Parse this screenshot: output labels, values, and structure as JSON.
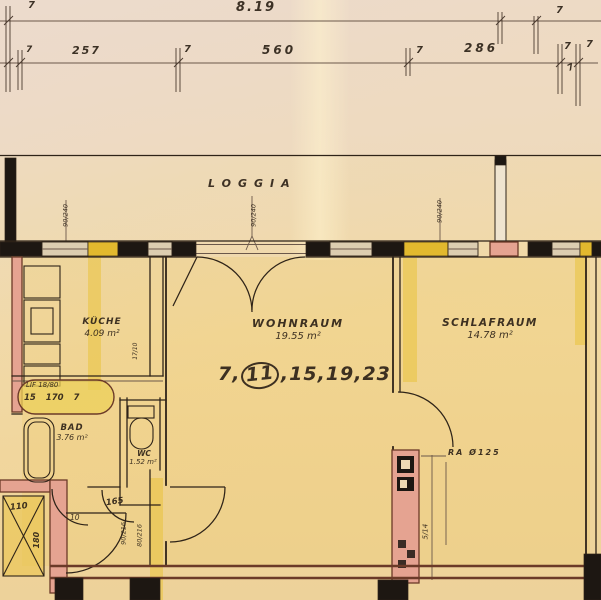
{
  "colors": {
    "paper": "#eed9b4",
    "ink": "#2e2318",
    "line_faint": "#6b584a",
    "dim": "#4a3a2e",
    "wall_black": "#1d1712",
    "wall_pink": "#e5a391",
    "wall_yellow": "#e2b92e",
    "window_beige": "#dccdb0",
    "wall_outline": "#6b3a28",
    "wash": "#eac23c"
  },
  "dimensions": {
    "overall": "8.19",
    "seg_left": "257",
    "seg_middle": "560",
    "seg_right": "286",
    "tick": "7"
  },
  "loggia": {
    "label": "LOGGIA"
  },
  "rooms": {
    "kueche": {
      "name": "KÜCHE",
      "area": "4.09 m²"
    },
    "wohnraum": {
      "name": "WOHNRAUM",
      "area": "19.55 m²"
    },
    "schlafraum": {
      "name": "SCHLAFRAUM",
      "area": "14.78 m²"
    },
    "bad": {
      "name": "BAD",
      "area": "3.76 m²"
    },
    "wc": {
      "name": "WC",
      "area": "1.52 m²"
    }
  },
  "apartment_numbers": {
    "prefix": "7,",
    "circled": "11",
    "suffix": ",15,19,23"
  },
  "annotations": {
    "lift_line1": "LIF 18/80",
    "lift_line2": "15  170  7",
    "duct_label": "RA Ø125",
    "duct_dim": "5/14",
    "shaft_width": "110",
    "shaft_depth": "180",
    "dim_10": "10",
    "hall_width": "165",
    "door_dim_a": "90/216",
    "door_dim_b": "80/216",
    "window_dim": "90/240",
    "kitchen_flue": "17/10"
  }
}
